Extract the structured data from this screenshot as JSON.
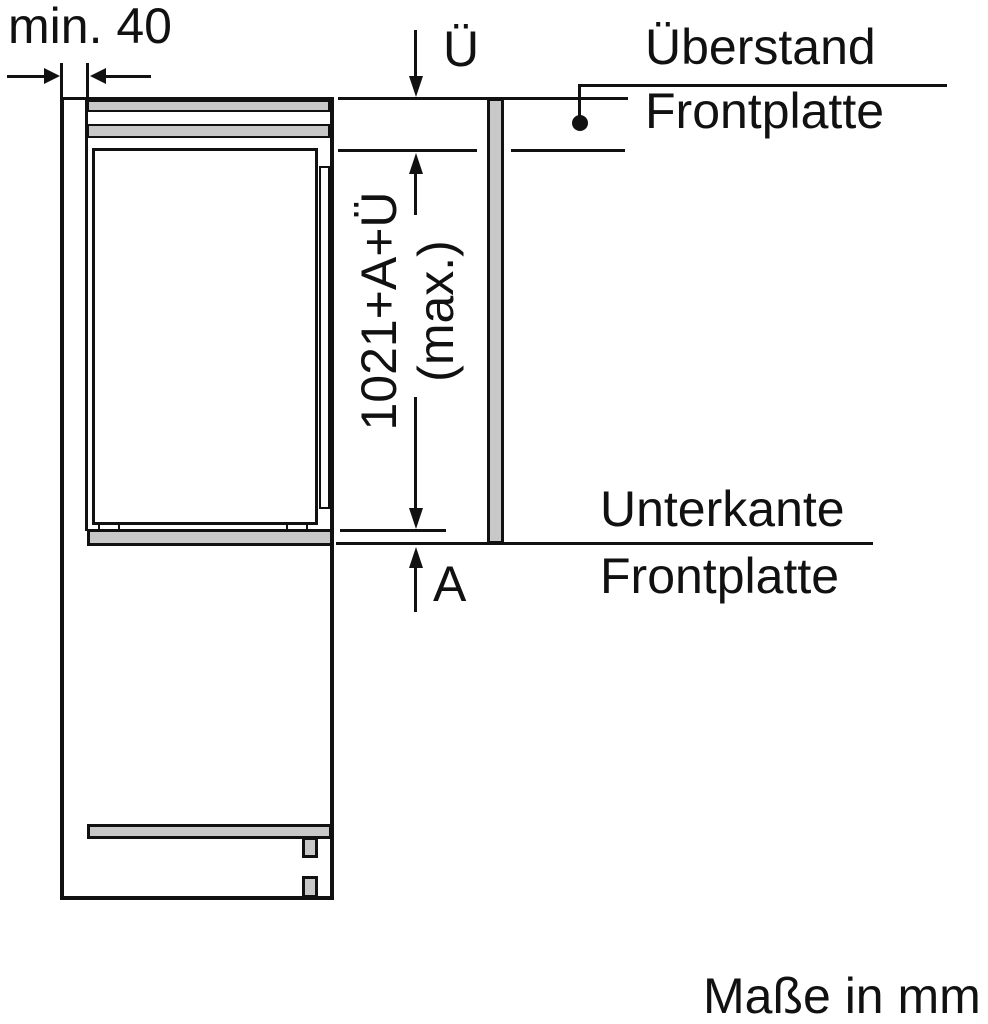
{
  "drawing": {
    "type": "appliance-installation-side-view",
    "labels": {
      "min_gap": "min. 40",
      "overhang_symbol": "Ü",
      "overhang_line1": "Überstand",
      "overhang_line2": "Frontplatte",
      "height_dim_line1": "1021+A+Ü",
      "height_dim_line2": "(max.)",
      "bottom_edge_line1": "Unterkante",
      "bottom_edge_line2": "Frontplatte",
      "gap_symbol": "A",
      "units_note": "Maße in mm"
    },
    "dimensions": {
      "min_side_clearance_mm": 40,
      "max_front_panel_height_formula": "1021+A+Ü (max.)"
    },
    "colors": {
      "line": "#111111",
      "panel_fill": "#c8c8c8",
      "background": "#ffffff"
    }
  }
}
